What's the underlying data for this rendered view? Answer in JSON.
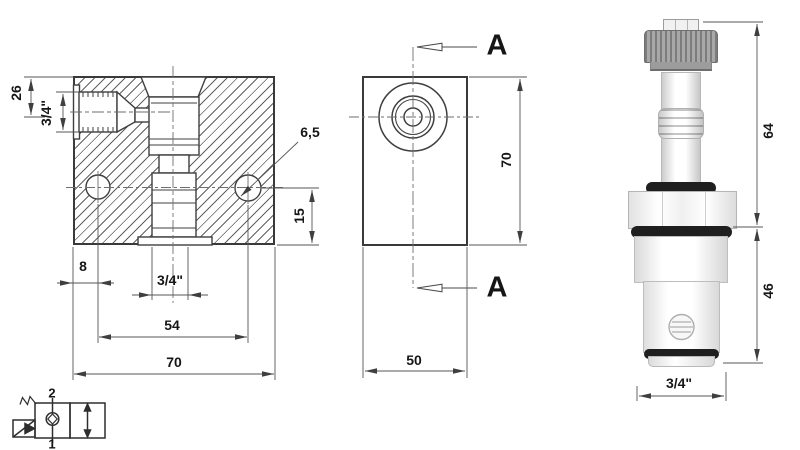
{
  "title": "2/2 solenoid cartridge valve 3/4\" - technical drawing",
  "labels": {
    "left_view": {
      "d26": "26",
      "d34_side": "3/4\"",
      "d65": "6,5",
      "d15": "15",
      "d8": "8",
      "d34_bottom": "3/4\"",
      "d54": "54",
      "d70": "70"
    },
    "middle_view": {
      "a_top": "A",
      "a_bottom": "A",
      "d70": "70",
      "d50": "50"
    },
    "valve_view": {
      "d64": "64",
      "d46": "46",
      "d34": "3/4\""
    },
    "symbol": {
      "port_top": "2",
      "port_bottom": "1"
    }
  },
  "colors": {
    "line": "#3f3f3f",
    "dim_line": "#5a5a5a",
    "text": "#161616",
    "hatch": "#606060",
    "oring_black": "#1f1f1f",
    "knurl_gray": "#8c8c8c"
  },
  "icons": {
    "solenoid_symbol": "solenoid-actuator",
    "spring_symbol": "return-spring",
    "check_valve_symbol": "seat-valve-closed",
    "flow_arrow_symbol": "two-way-flow"
  }
}
